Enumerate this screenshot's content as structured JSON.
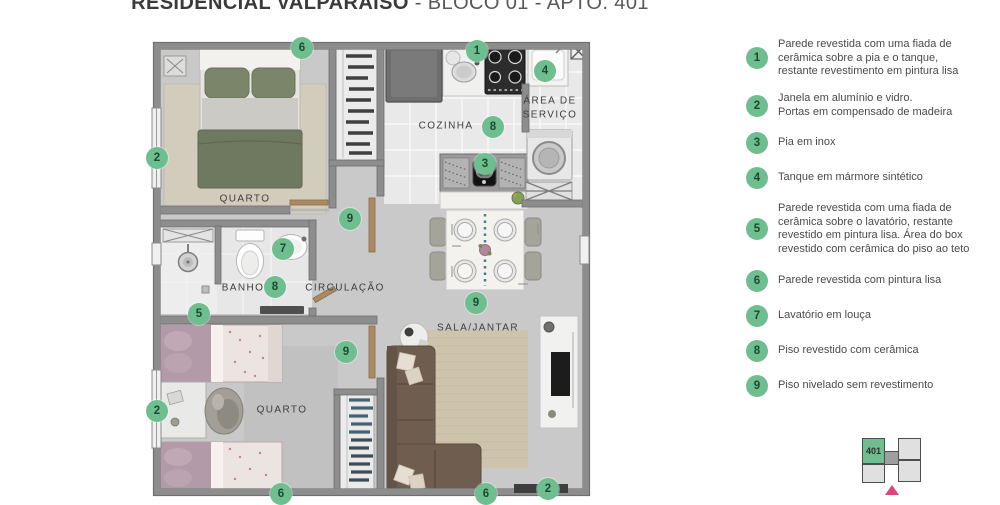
{
  "title": {
    "main": "RESIDENCIAL VALPARAÍSO",
    "suffix": " - BLOCO 01 - APTO. 401"
  },
  "colors": {
    "accent_green": "#6FBE8F",
    "marker_number": "#1C4A30",
    "title_text": "#3A3A3A",
    "legend_text": "#4A4A4A",
    "keyplan_highlight": "#6FBE8F",
    "keyplan_arrow": "#E0457E"
  },
  "plan": {
    "rooms": [
      {
        "label": "QUARTO",
        "x": 97,
        "y": 159
      },
      {
        "label": "COZINHA",
        "x": 298,
        "y": 86
      },
      {
        "label": "ÁREA DE\nSERVIÇO",
        "x": 402,
        "y": 68
      },
      {
        "label": "BANHO",
        "x": 95,
        "y": 248
      },
      {
        "label": "CIRCULAÇÃO",
        "x": 197,
        "y": 248
      },
      {
        "label": "SALA/JANTAR",
        "x": 330,
        "y": 288
      },
      {
        "label": "QUARTO",
        "x": 134,
        "y": 370
      }
    ],
    "markers": [
      {
        "n": "6",
        "x": 154,
        "y": 8
      },
      {
        "n": "1",
        "x": 329,
        "y": 11
      },
      {
        "n": "4",
        "x": 397,
        "y": 31
      },
      {
        "n": "2",
        "x": 9,
        "y": 118
      },
      {
        "n": "8",
        "x": 345,
        "y": 87
      },
      {
        "n": "3",
        "x": 337,
        "y": 124
      },
      {
        "n": "9",
        "x": 202,
        "y": 179
      },
      {
        "n": "7",
        "x": 135,
        "y": 209
      },
      {
        "n": "8",
        "x": 127,
        "y": 247
      },
      {
        "n": "5",
        "x": 51,
        "y": 274
      },
      {
        "n": "9",
        "x": 198,
        "y": 312
      },
      {
        "n": "9",
        "x": 328,
        "y": 263
      },
      {
        "n": "2",
        "x": 9,
        "y": 371
      },
      {
        "n": "6",
        "x": 133,
        "y": 454
      },
      {
        "n": "6",
        "x": 338,
        "y": 454
      },
      {
        "n": "2",
        "x": 400,
        "y": 449
      }
    ]
  },
  "legend": {
    "items": [
      {
        "num": "1",
        "text": "Parede revestida com uma fiada de\ncerâmica sobre a pia e o tanque,\nrestante revestimento em pintura lisa"
      },
      {
        "num": "2",
        "text": "Janela em alumínio e vidro.\nPortas em compensado de madeira"
      },
      {
        "num": "3",
        "text": "Pia em inox"
      },
      {
        "num": "4",
        "text": "Tanque em mármore sintético"
      },
      {
        "num": "5",
        "text": "Parede revestida com uma fiada de\ncerâmica sobre o lavatório, restante\nrevestido em pintura lisa. Área do box\nrevestido com cerâmica do piso ao teto"
      },
      {
        "num": "6",
        "text": "Parede revestida com pintura lisa"
      },
      {
        "num": "7",
        "text": "Lavatório em louça"
      },
      {
        "num": "8",
        "text": "Piso revestido com cerâmica"
      },
      {
        "num": "9",
        "text": "Piso nivelado sem revestimento"
      }
    ]
  },
  "keyplan": {
    "unit_label": "401"
  }
}
